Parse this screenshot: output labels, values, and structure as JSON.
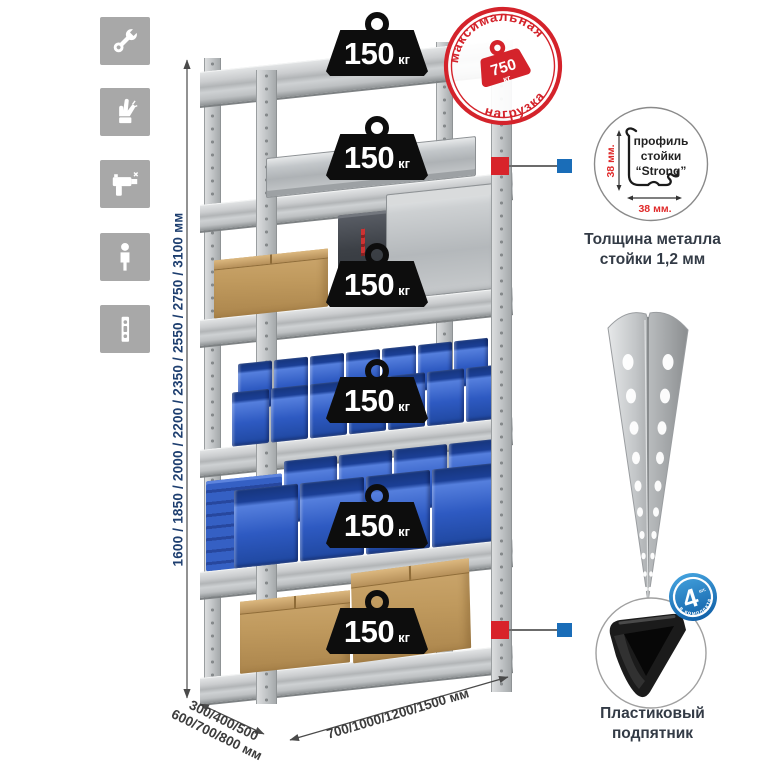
{
  "colors": {
    "tile_gray": "#a8a8a8",
    "stamp_red": "#d4232b",
    "dim_blue_text": "#1d3e6f",
    "connector_red": "#d8232a",
    "connector_blue": "#1a6db8",
    "badge_black": "#0d0d0d",
    "bin_blue": "#2e5ac2"
  },
  "sidebar": {
    "icons": [
      {
        "name": "wrench-icon"
      },
      {
        "name": "gloves-icon"
      },
      {
        "name": "drill-icon"
      },
      {
        "name": "person-icon"
      },
      {
        "name": "perforated-post-icon"
      }
    ]
  },
  "dimensions": {
    "height_label": "1600 / 1850 / 2000 / 2200 / 2350 / 2550 / 2750 / 3100 мм",
    "depth_line1": "300/400/500",
    "depth_line2": "600/700/800 мм",
    "width_label": "700/1000/1200/1500 мм"
  },
  "badges": [
    {
      "value": "150",
      "unit": "кг"
    },
    {
      "value": "150",
      "unit": "кг"
    },
    {
      "value": "150",
      "unit": "кг"
    },
    {
      "value": "150",
      "unit": "кг"
    },
    {
      "value": "150",
      "unit": "кг"
    },
    {
      "value": "150",
      "unit": "кг"
    }
  ],
  "stamp": {
    "arc_top": "максимальная",
    "arc_bottom": "нагрузка",
    "value": "750",
    "unit": "кг"
  },
  "profile_detail": {
    "line1": "профиль",
    "line2": "стойки",
    "line3": "“Strong”",
    "dim_v": "38 мм.",
    "dim_h": "38 мм.",
    "caption1": "Толщина металла",
    "caption2": "стойки 1,2 мм"
  },
  "foot_detail": {
    "badge_value": "4",
    "badge_note": "шт.",
    "badge_arc": "в комплекте",
    "caption1": "Пластиковый",
    "caption2": "подпятник"
  }
}
